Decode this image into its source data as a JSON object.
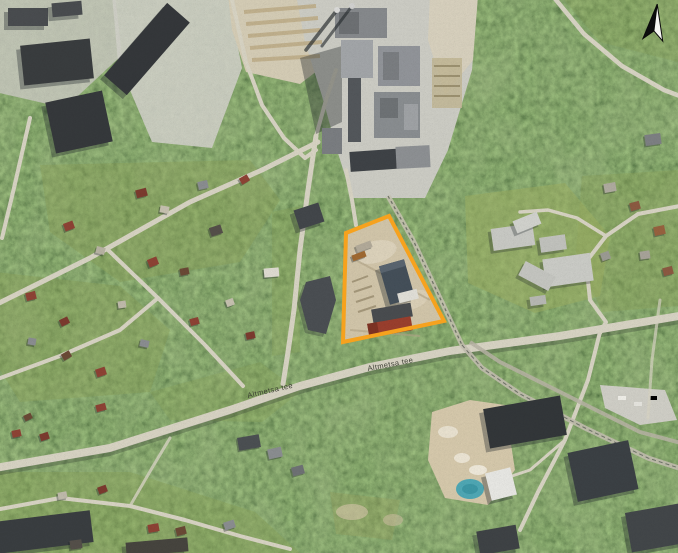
{
  "map": {
    "description": "Aerial orthophoto with highlighted development site boundary, factory complex to the north, forest and residential areas around",
    "road_labels": [
      {
        "text": "Altmetsa tee"
      },
      {
        "text": "Altmetsa tee"
      }
    ],
    "site_boundary": {
      "points": "346,233 389,216 444,321 343,342",
      "color": "#F6A21E"
    },
    "north_arrow": {
      "symbol": "north-arrow"
    },
    "palette": {
      "forest": "#49583c",
      "clearing": "#8ba157",
      "road": "#d8d4c4",
      "industrial_ground": "#cdcdc5",
      "sand": "#d2c6aa",
      "dark_roof": "#33373a",
      "red_roof": "#8e4335",
      "pond": "#4fa8b5",
      "boundary_orange": "#F6A21E"
    }
  }
}
